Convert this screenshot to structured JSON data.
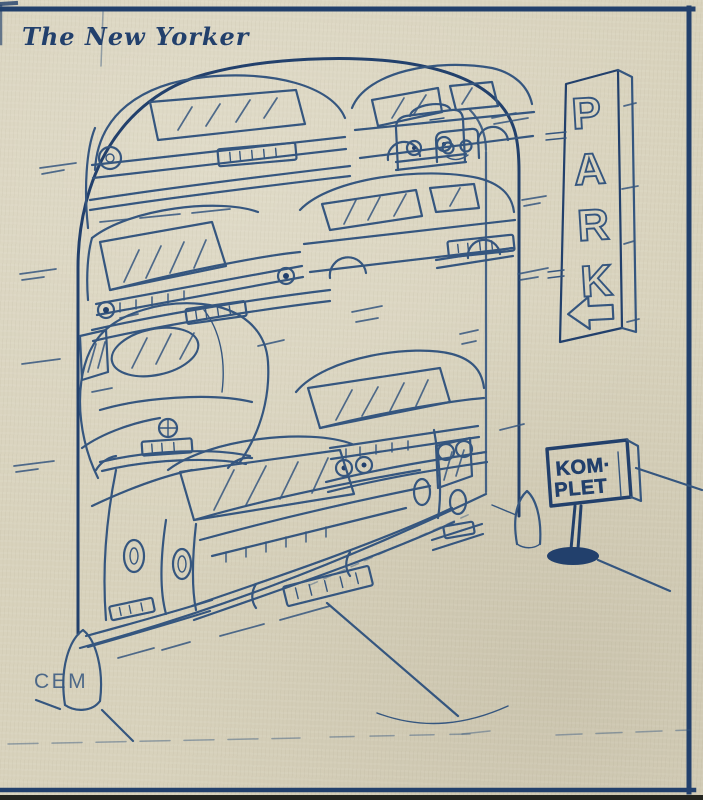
{
  "publication": {
    "title": "The New Yorker"
  },
  "artist": {
    "signature": "CEM"
  },
  "park_sign": {
    "letters": [
      "P",
      "A",
      "R",
      "K"
    ],
    "arrow": "left-arrow"
  },
  "full_sign": {
    "line1": "KOM·",
    "line2": "PLET"
  },
  "colors": {
    "paper": "#d8d2bc",
    "ink": "#35567f",
    "ink_dark": "#22406c",
    "border": "#22406c"
  }
}
